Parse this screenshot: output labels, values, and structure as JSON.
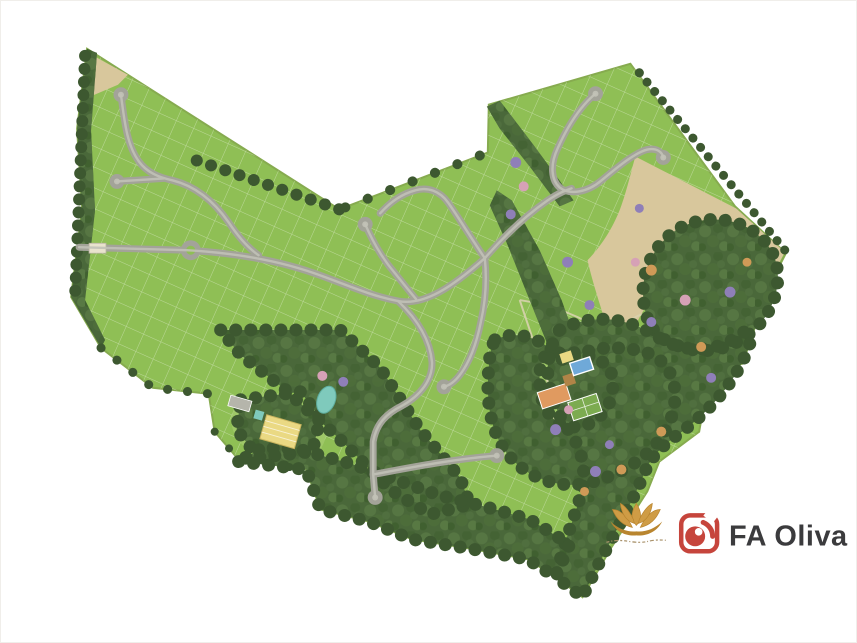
{
  "page": {
    "background": "#ffffff",
    "border": "#f0eeea"
  },
  "branding": {
    "partner_logo": {
      "label": "FA Oliva",
      "icon": "red-rounded-square-lens-icon",
      "icon_color": "#c6453c",
      "text_color": "#3b3b3d"
    },
    "project_logo": {
      "icon": "gold-lotus-flower-icon",
      "color": "#cf9c45",
      "accent": "#b9852f",
      "script_color": "#a9926b"
    }
  },
  "map": {
    "kind": "residential-masterplan-siteplan",
    "palette": {
      "lot_green": "#8fbf55",
      "lot_edge": "#86ab4f",
      "clearing_green": "#9fc868",
      "road_gray": "#a3a399",
      "road_center": "#c2c2b7",
      "forest_green": "#4a683a",
      "forest_dark": "#3d5830",
      "field_tan": "#d8c79c",
      "pond_teal": "#7fcabc",
      "pool_blue": "#6fa9d8",
      "court_orange": "#e09a60",
      "court_green": "#7cab50",
      "deck_brown": "#b08447",
      "building_yellow": "#ead983",
      "building_trim": "#c9b45e",
      "parking_gray": "#b5b5ab",
      "accent_purple": "#8f7fb8",
      "accent_pink": "#d6a1b6",
      "accent_orange": "#cf9a57",
      "trail_tan": "#d8d2ae",
      "gate_tan": "#e9e3cd"
    }
  }
}
